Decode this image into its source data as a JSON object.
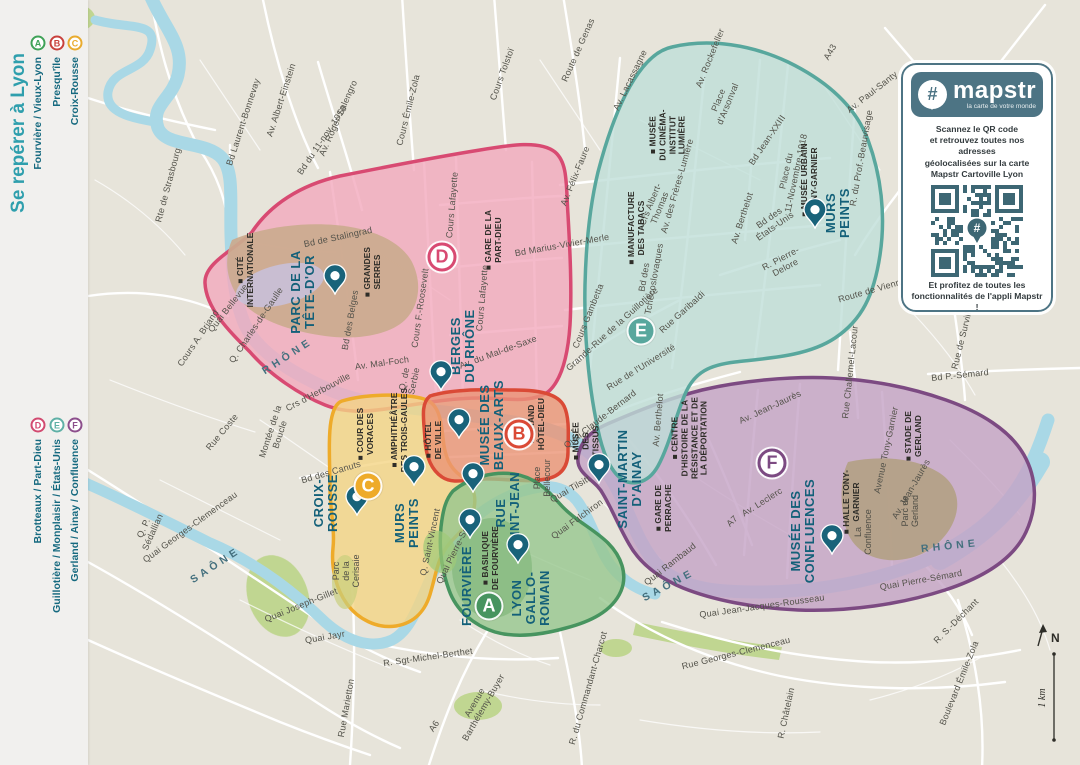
{
  "sidebar": {
    "title": "Se repérer à Lyon",
    "groups": [
      {
        "items": [
          {
            "letter": "A",
            "color": "#3fa257",
            "label": "Fourvière / Vieux-Lyon"
          },
          {
            "letter": "B",
            "color": "#c8403c",
            "label": "Presqu'île"
          },
          {
            "letter": "C",
            "color": "#e9ab2e",
            "label": "Croix-Rousse"
          }
        ]
      },
      {
        "items": [
          {
            "letter": "D",
            "color": "#d24a70",
            "label": "Brotteaux / Part-Dieu"
          },
          {
            "letter": "E",
            "color": "#5fb0a6",
            "label": "Guillotière / Monplaisir / États-Unis"
          },
          {
            "letter": "F",
            "color": "#8c4e8c",
            "label": "Gerland / Ainay / Confluence"
          }
        ]
      }
    ]
  },
  "zones": [
    {
      "letter": "D",
      "fill": "#f2a9bd",
      "stroke": "#d84a72",
      "style": "ring",
      "x": 442,
      "y": 257
    },
    {
      "letter": "C",
      "fill": "#f4d584",
      "stroke": "#eeab2a",
      "style": "filled",
      "x": 368,
      "y": 486
    },
    {
      "letter": "B",
      "fill": "#eb9475",
      "stroke": "#da4a36",
      "style": "ring",
      "x": 519,
      "y": 434
    },
    {
      "letter": "F",
      "fill": "#c4a3c6",
      "stroke": "#7c4a82",
      "style": "ring",
      "x": 772,
      "y": 463
    },
    {
      "letter": "E",
      "fill": "#bfdfd8",
      "stroke": "#58a79d",
      "style": "filled",
      "x": 641,
      "y": 331
    },
    {
      "letter": "A",
      "fill": "#97c78f",
      "stroke": "#47945f",
      "style": "filled",
      "x": 489,
      "y": 606
    }
  ],
  "map": {
    "poi_major": [
      {
        "t": "PARC DE LA\nTÊTE-D'OR",
        "x": 303,
        "y": 292,
        "pin": {
          "x": 335,
          "y": 298
        }
      },
      {
        "t": "BERGES\nDU RHÔNE",
        "x": 463,
        "y": 346,
        "pin": {
          "x": 441,
          "y": 394
        }
      },
      {
        "t": "MUSÉE DES\nBEAUX-ARTS",
        "x": 492,
        "y": 425,
        "pin": {
          "x": 459,
          "y": 442
        }
      },
      {
        "t": "MURS\nPEINTS",
        "x": 838,
        "y": 213,
        "pin": {
          "x": 815,
          "y": 232
        }
      },
      {
        "t": "CROIX-\nROUSSE",
        "x": 326,
        "y": 503,
        "pin": {
          "x": 357,
          "y": 519
        }
      },
      {
        "t": "MURS\nPEINTS",
        "x": 407,
        "y": 523,
        "pin": {
          "x": 414,
          "y": 489
        }
      },
      {
        "t": "RUE\nSAINT-JEAN",
        "x": 508,
        "y": 513,
        "pin": {
          "x": 473,
          "y": 496
        }
      },
      {
        "t": "FOURVIÈRE",
        "x": 467,
        "y": 586,
        "pin": {
          "x": 470,
          "y": 542
        }
      },
      {
        "t": "LYON\nGALLO-\nROMAIN",
        "x": 531,
        "y": 598,
        "pin": {
          "x": 518,
          "y": 567
        }
      },
      {
        "t": "SAINT-MARTIN\nD'AINAY",
        "x": 630,
        "y": 479,
        "pin": {
          "x": 599,
          "y": 487
        }
      },
      {
        "t": "MUSÉE DES\nCONFLUENCES",
        "x": 803,
        "y": 531,
        "pin": {
          "x": 832,
          "y": 558
        }
      }
    ],
    "poi_minor": [
      {
        "t": "■ CITÉ\nINTERNATIONALE",
        "x": 246,
        "y": 270
      },
      {
        "t": "■ GRANDES\nSERRES",
        "x": 373,
        "y": 272
      },
      {
        "t": "■ GARE DE LA\nPART-DIEU",
        "x": 494,
        "y": 240
      },
      {
        "t": "■ MUSÉE\nDU CINÉMA-\nINSTITUT\nLUMIÈRE",
        "x": 668,
        "y": 135
      },
      {
        "t": "■ MANUFACTURE\nDES TABACS",
        "x": 637,
        "y": 228
      },
      {
        "t": "■ MUSÉE URBAIN\nTONY-GARNIER",
        "x": 810,
        "y": 180
      },
      {
        "t": "■ HÔTEL\nDE VILLE",
        "x": 434,
        "y": 440
      },
      {
        "t": "■ GRAND\nHÔTEL-DIEU",
        "x": 537,
        "y": 424
      },
      {
        "t": "■ MUSÉE\nDES\nTISSUS",
        "x": 586,
        "y": 441
      },
      {
        "t": "■ GARE DE\nPERRACHE",
        "x": 664,
        "y": 508
      },
      {
        "t": "■ CENTRE\nD'HISTOIRE DE LA\nRÉSISTANCE ET DE\nLA DÉPORTATION",
        "x": 690,
        "y": 438
      },
      {
        "t": "■ HALLE TONY-\nGARNIER",
        "x": 852,
        "y": 502
      },
      {
        "t": "■ STADE DE\nGERLAND",
        "x": 914,
        "y": 436
      },
      {
        "t": "■ COUR DES\nVORACES",
        "x": 366,
        "y": 434
      },
      {
        "t": "■ AMPHITHÉÂTRE\nDES TROIS-GAULES",
        "x": 400,
        "y": 430
      },
      {
        "t": "■ BASILIQUE\nDE FOURVIÈRE",
        "x": 491,
        "y": 558
      }
    ],
    "poi_plain": [
      {
        "t": "Parc\nde la\nCerisaie",
        "x": 346,
        "y": 571
      },
      {
        "t": "Place\nBellecour",
        "x": 542,
        "y": 478
      },
      {
        "t": "Parc de\nGerland",
        "x": 910,
        "y": 511
      },
      {
        "t": "La\nConfluence",
        "x": 863,
        "y": 532
      }
    ],
    "street_labels": [
      {
        "t": "Rte de Strasbourg",
        "x": 168,
        "y": 185,
        "r": -75
      },
      {
        "t": "Bd Laurent-Bonnevay",
        "x": 243,
        "y": 122,
        "r": -72
      },
      {
        "t": "Av. Albert-Einstein",
        "x": 281,
        "y": 100,
        "r": -72
      },
      {
        "t": "Av. Roger-Salengro",
        "x": 338,
        "y": 118,
        "r": -66
      },
      {
        "t": "Cours Émile-Zola",
        "x": 408,
        "y": 110,
        "r": -76
      },
      {
        "t": "Cours Tolstoï",
        "x": 502,
        "y": 74,
        "r": -70
      },
      {
        "t": "Route de Genas",
        "x": 578,
        "y": 50,
        "r": -66
      },
      {
        "t": "Av. Lacassagne",
        "x": 630,
        "y": 80,
        "r": -64
      },
      {
        "t": "Av. Rockefeller",
        "x": 710,
        "y": 58,
        "r": -68
      },
      {
        "t": "Place\nd'Arsonval",
        "x": 723,
        "y": 102,
        "r": -68
      },
      {
        "t": "A43",
        "x": 830,
        "y": 52,
        "r": -60
      },
      {
        "t": "Av. Paul-Santy",
        "x": 872,
        "y": 92,
        "r": -38
      },
      {
        "t": "R. du Prof.-Beauvisage",
        "x": 861,
        "y": 158,
        "r": -80
      },
      {
        "t": "Av. Félix-Faure",
        "x": 575,
        "y": 176,
        "r": -68
      },
      {
        "t": "Bd Jean-XXIII",
        "x": 767,
        "y": 140,
        "r": -56
      },
      {
        "t": "Place du\n11-Novembre-1918",
        "x": 791,
        "y": 172,
        "r": -78
      },
      {
        "t": "Av. Berthelot",
        "x": 742,
        "y": 218,
        "r": -72
      },
      {
        "t": "Av. Berthelot",
        "x": 658,
        "y": 420,
        "r": -85
      },
      {
        "t": "Bd des\nÉtats-Unis",
        "x": 772,
        "y": 222,
        "r": -35
      },
      {
        "t": "R. Pierre-\nDelore",
        "x": 783,
        "y": 263,
        "r": -28
      },
      {
        "t": "Route de Vienne",
        "x": 872,
        "y": 290,
        "r": -16
      },
      {
        "t": "Crs Albert-\nThomas",
        "x": 655,
        "y": 206,
        "r": -68
      },
      {
        "t": "Av. des Frères-Lumière",
        "x": 677,
        "y": 186,
        "r": -74
      },
      {
        "t": "Bd des\nTchécoslovaques",
        "x": 649,
        "y": 278,
        "r": -80
      },
      {
        "t": "Bd Marius-Vivier-Merle",
        "x": 562,
        "y": 245,
        "r": -10
      },
      {
        "t": "Cours Gambetta",
        "x": 588,
        "y": 316,
        "r": -68
      },
      {
        "t": "Grande-Rue de la Guillotière",
        "x": 612,
        "y": 329,
        "r": -42
      },
      {
        "t": "Rue Garibaldi",
        "x": 682,
        "y": 312,
        "r": -42
      },
      {
        "t": "Quai Claude-Bernard",
        "x": 600,
        "y": 419,
        "r": -38
      },
      {
        "t": "Rue de l'Université",
        "x": 641,
        "y": 367,
        "r": -32
      },
      {
        "t": "Av. du Mal-de-Saxe",
        "x": 498,
        "y": 352,
        "r": -20
      },
      {
        "t": "Q. de\nSerbie",
        "x": 409,
        "y": 380,
        "r": -78
      },
      {
        "t": "Av. Mal-Foch",
        "x": 382,
        "y": 363,
        "r": -8
      },
      {
        "t": "Cours F.-Roosevelt",
        "x": 420,
        "y": 308,
        "r": -82
      },
      {
        "t": "Cours Lafayette",
        "x": 452,
        "y": 205,
        "r": -85
      },
      {
        "t": "Cours Lafayette",
        "x": 482,
        "y": 298,
        "r": -85
      },
      {
        "t": "Bd du 11-nov.-1918",
        "x": 322,
        "y": 140,
        "r": -56
      },
      {
        "t": "Bd de Stalingrad",
        "x": 338,
        "y": 237,
        "r": -12
      },
      {
        "t": "Bd des Belges",
        "x": 350,
        "y": 320,
        "r": -80
      },
      {
        "t": "Q. Charles-de-Gaulle",
        "x": 256,
        "y": 325,
        "r": -56
      },
      {
        "t": "Quai Bellevue",
        "x": 228,
        "y": 308,
        "r": -52
      },
      {
        "t": "Cours A. Briand",
        "x": 198,
        "y": 338,
        "r": -56
      },
      {
        "t": "Crs d'Herbouville",
        "x": 318,
        "y": 392,
        "r": -28
      },
      {
        "t": "Montée de la\nBoucle",
        "x": 275,
        "y": 433,
        "r": -72
      },
      {
        "t": "Rue Coste",
        "x": 222,
        "y": 432,
        "r": -50
      },
      {
        "t": "Bd des Canuts",
        "x": 331,
        "y": 472,
        "r": -16
      },
      {
        "t": "Q. Saint-Vincent",
        "x": 430,
        "y": 542,
        "r": -78
      },
      {
        "t": "Quai Pierre-Scize",
        "x": 455,
        "y": 550,
        "r": -64
      },
      {
        "t": "Quai Georges-Clemenceau",
        "x": 190,
        "y": 527,
        "r": -36
      },
      {
        "t": "Q. P.\nSédallian",
        "x": 148,
        "y": 530,
        "r": -66
      },
      {
        "t": "Quai Joseph-Gillet",
        "x": 301,
        "y": 605,
        "r": -22
      },
      {
        "t": "Quai Jayr",
        "x": 325,
        "y": 637,
        "r": -10
      },
      {
        "t": "Rue Marietton",
        "x": 346,
        "y": 708,
        "r": -80
      },
      {
        "t": "R. Sgt-Michel-Berthet",
        "x": 428,
        "y": 657,
        "r": -8
      },
      {
        "t": "Avenue\nBarthélemy-Buyer",
        "x": 479,
        "y": 705,
        "r": -60
      },
      {
        "t": "A6",
        "x": 434,
        "y": 726,
        "r": -56
      },
      {
        "t": "R. du Commandant-Charcot",
        "x": 588,
        "y": 688,
        "r": -74
      },
      {
        "t": "Quai Fulchiron",
        "x": 577,
        "y": 519,
        "r": -36
      },
      {
        "t": "Quai Tilsitt",
        "x": 570,
        "y": 489,
        "r": -30
      },
      {
        "t": "Quai Rambaud",
        "x": 670,
        "y": 564,
        "r": -38
      },
      {
        "t": "Quai Jean-Jacques-Rousseau",
        "x": 762,
        "y": 606,
        "r": -8
      },
      {
        "t": "Rue Georges-Clemenceau",
        "x": 736,
        "y": 653,
        "r": -14
      },
      {
        "t": "R. Châtelain",
        "x": 786,
        "y": 713,
        "r": -78
      },
      {
        "t": "R. S.-Déchant",
        "x": 956,
        "y": 621,
        "r": -45
      },
      {
        "t": "Boulevard Émile-Zola",
        "x": 959,
        "y": 683,
        "r": -68
      },
      {
        "t": "Quai Pierre-Sémard",
        "x": 921,
        "y": 580,
        "r": -10
      },
      {
        "t": "Av. Leclerc",
        "x": 762,
        "y": 502,
        "r": -32
      },
      {
        "t": "A7",
        "x": 732,
        "y": 521,
        "r": -45
      },
      {
        "t": "Av. Jean-Jaurès",
        "x": 770,
        "y": 407,
        "r": -25
      },
      {
        "t": "Av. Jean-Jaurès",
        "x": 911,
        "y": 489,
        "r": -60
      },
      {
        "t": "Avenue Tony-Garnier",
        "x": 886,
        "y": 450,
        "r": -78
      },
      {
        "t": "Rue Challemel-Lacour",
        "x": 850,
        "y": 372,
        "r": -84
      },
      {
        "t": "Bd P.-Sémard",
        "x": 960,
        "y": 375,
        "r": -6
      },
      {
        "t": "Rue de Surville",
        "x": 962,
        "y": 338,
        "r": -76
      }
    ],
    "river_labels": [
      {
        "t": "RHÔNE",
        "x": 288,
        "y": 357,
        "r": -33
      },
      {
        "t": "RHÔNE",
        "x": 950,
        "y": 547,
        "r": -6
      },
      {
        "t": "SAÔNE",
        "x": 216,
        "y": 566,
        "r": -33
      },
      {
        "t": "SAÔNE",
        "x": 669,
        "y": 586,
        "r": -28
      }
    ]
  },
  "mapstr_card": {
    "hash": "#",
    "brand": "mapstr",
    "tagline": "la carte de votre monde",
    "scan_text": "Scannez le QR code\net retrouvez toutes nos adresses\ngéolocalisées sur la carte\nMapstr Cartoville Lyon",
    "footer_text": "Et profitez de toutes les\nfonctionnalités de l'appli Mapstr !"
  },
  "compass": {
    "north": "N",
    "scale": "1 km"
  },
  "colors": {
    "map_background": "#e7e4da",
    "water": "#a9d8e6",
    "poi_teal": "#136079",
    "card_teal": "#4d7484",
    "green_space": "#bcd489",
    "park_tan": "#cbaa8e"
  }
}
